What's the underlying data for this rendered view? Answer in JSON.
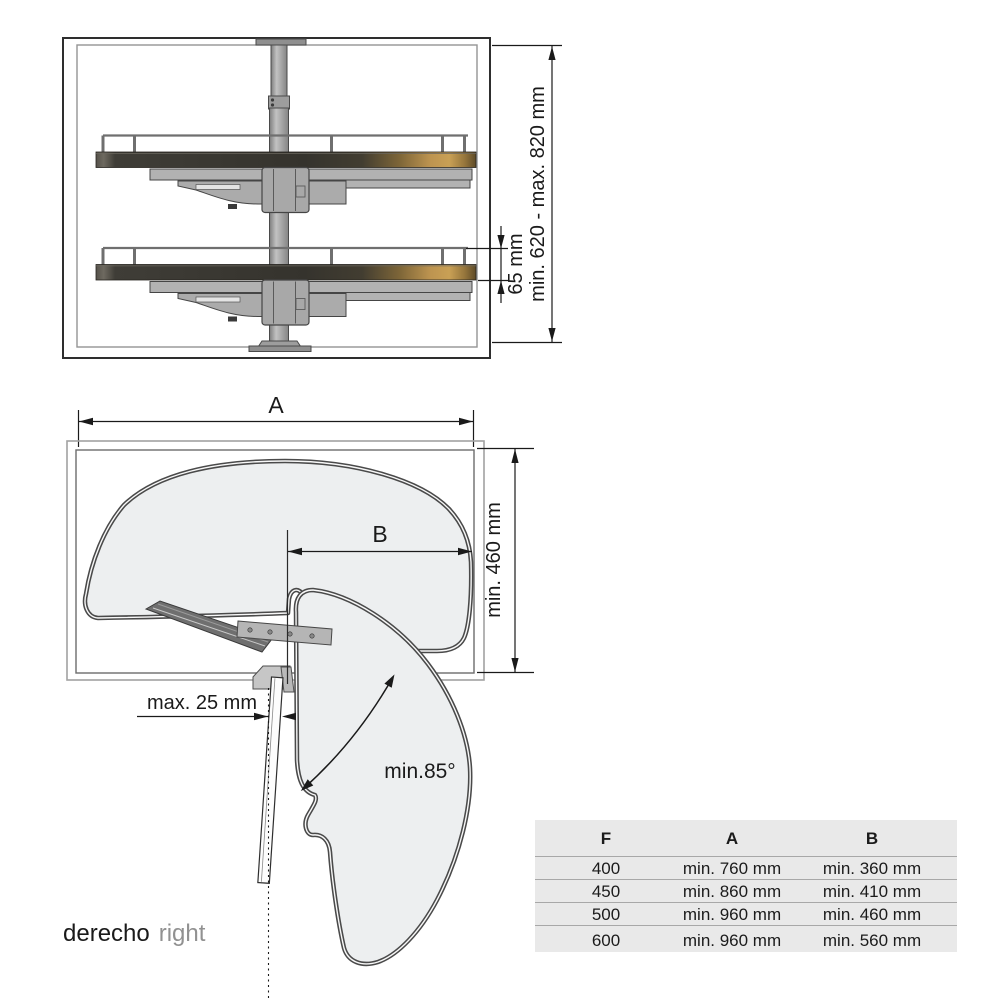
{
  "front_view": {
    "height_label": "min. 620 - max. 820 mm",
    "rail_label": "65 mm"
  },
  "plan_view": {
    "width_label": "A",
    "b_label": "B",
    "depth_label": "min. 460 mm",
    "door_gap_label": "max. 25 mm",
    "angle_label": "min.85°"
  },
  "footer": {
    "primary": "derecho",
    "secondary": "right"
  },
  "table": {
    "headers": [
      "F",
      "A",
      "B"
    ],
    "rows": [
      {
        "f": "400",
        "a": "min. 760 mm",
        "b": "min. 360 mm"
      },
      {
        "f": "450",
        "a": "min. 860 mm",
        "b": "min. 410 mm"
      },
      {
        "f": "500",
        "a": "min. 960 mm",
        "b": "min. 460 mm"
      },
      {
        "f": "600",
        "a": "min. 960 mm",
        "b": "min. 560 mm"
      }
    ]
  },
  "colors": {
    "line": "#1a1a1a",
    "shelf_wood_accent": "#c9a055",
    "tray_dark": "#38362f",
    "mechanism_gray": "#b0b0b0",
    "table_background": "#e9e9e9",
    "secondary_text": "#919191"
  }
}
